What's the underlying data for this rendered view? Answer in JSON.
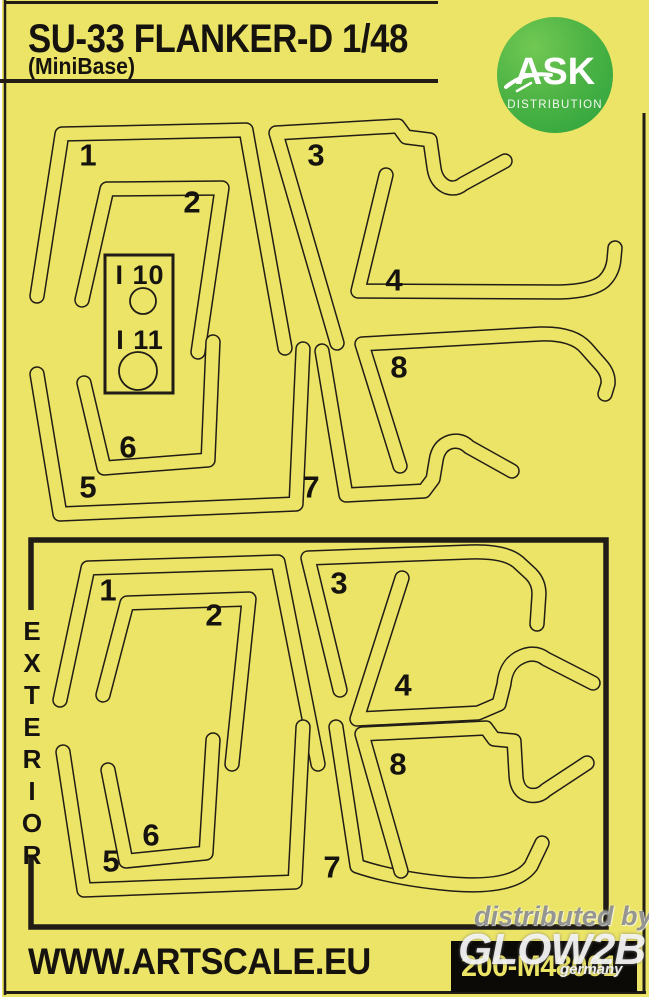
{
  "header": {
    "title": "SU-33 FLANKER-D 1/48",
    "subtitle": "(MiniBase)"
  },
  "logo": {
    "brand": "ASK",
    "tagline": "DISTRIBUTION"
  },
  "interior": {
    "labels": [
      "1",
      "2",
      "3",
      "4",
      "5",
      "6",
      "7",
      "8"
    ],
    "inserts": [
      "I 10",
      "I 11"
    ]
  },
  "exterior": {
    "section_label": "EXTERIOR",
    "labels": [
      "1",
      "2",
      "3",
      "4",
      "5",
      "6",
      "7",
      "8"
    ]
  },
  "footer": {
    "website": "WWW.ARTSCALE.EU",
    "product_code": "200-M48001"
  },
  "watermark": {
    "line1": "distributed by",
    "line2": "GLOW2B",
    "line3": "germany"
  },
  "colors": {
    "sheet": "#ebe466",
    "line": "#211d16",
    "logo_green_light": "#72c853",
    "logo_green_dark": "#2aa23d",
    "code_box": "#0c0a07"
  }
}
